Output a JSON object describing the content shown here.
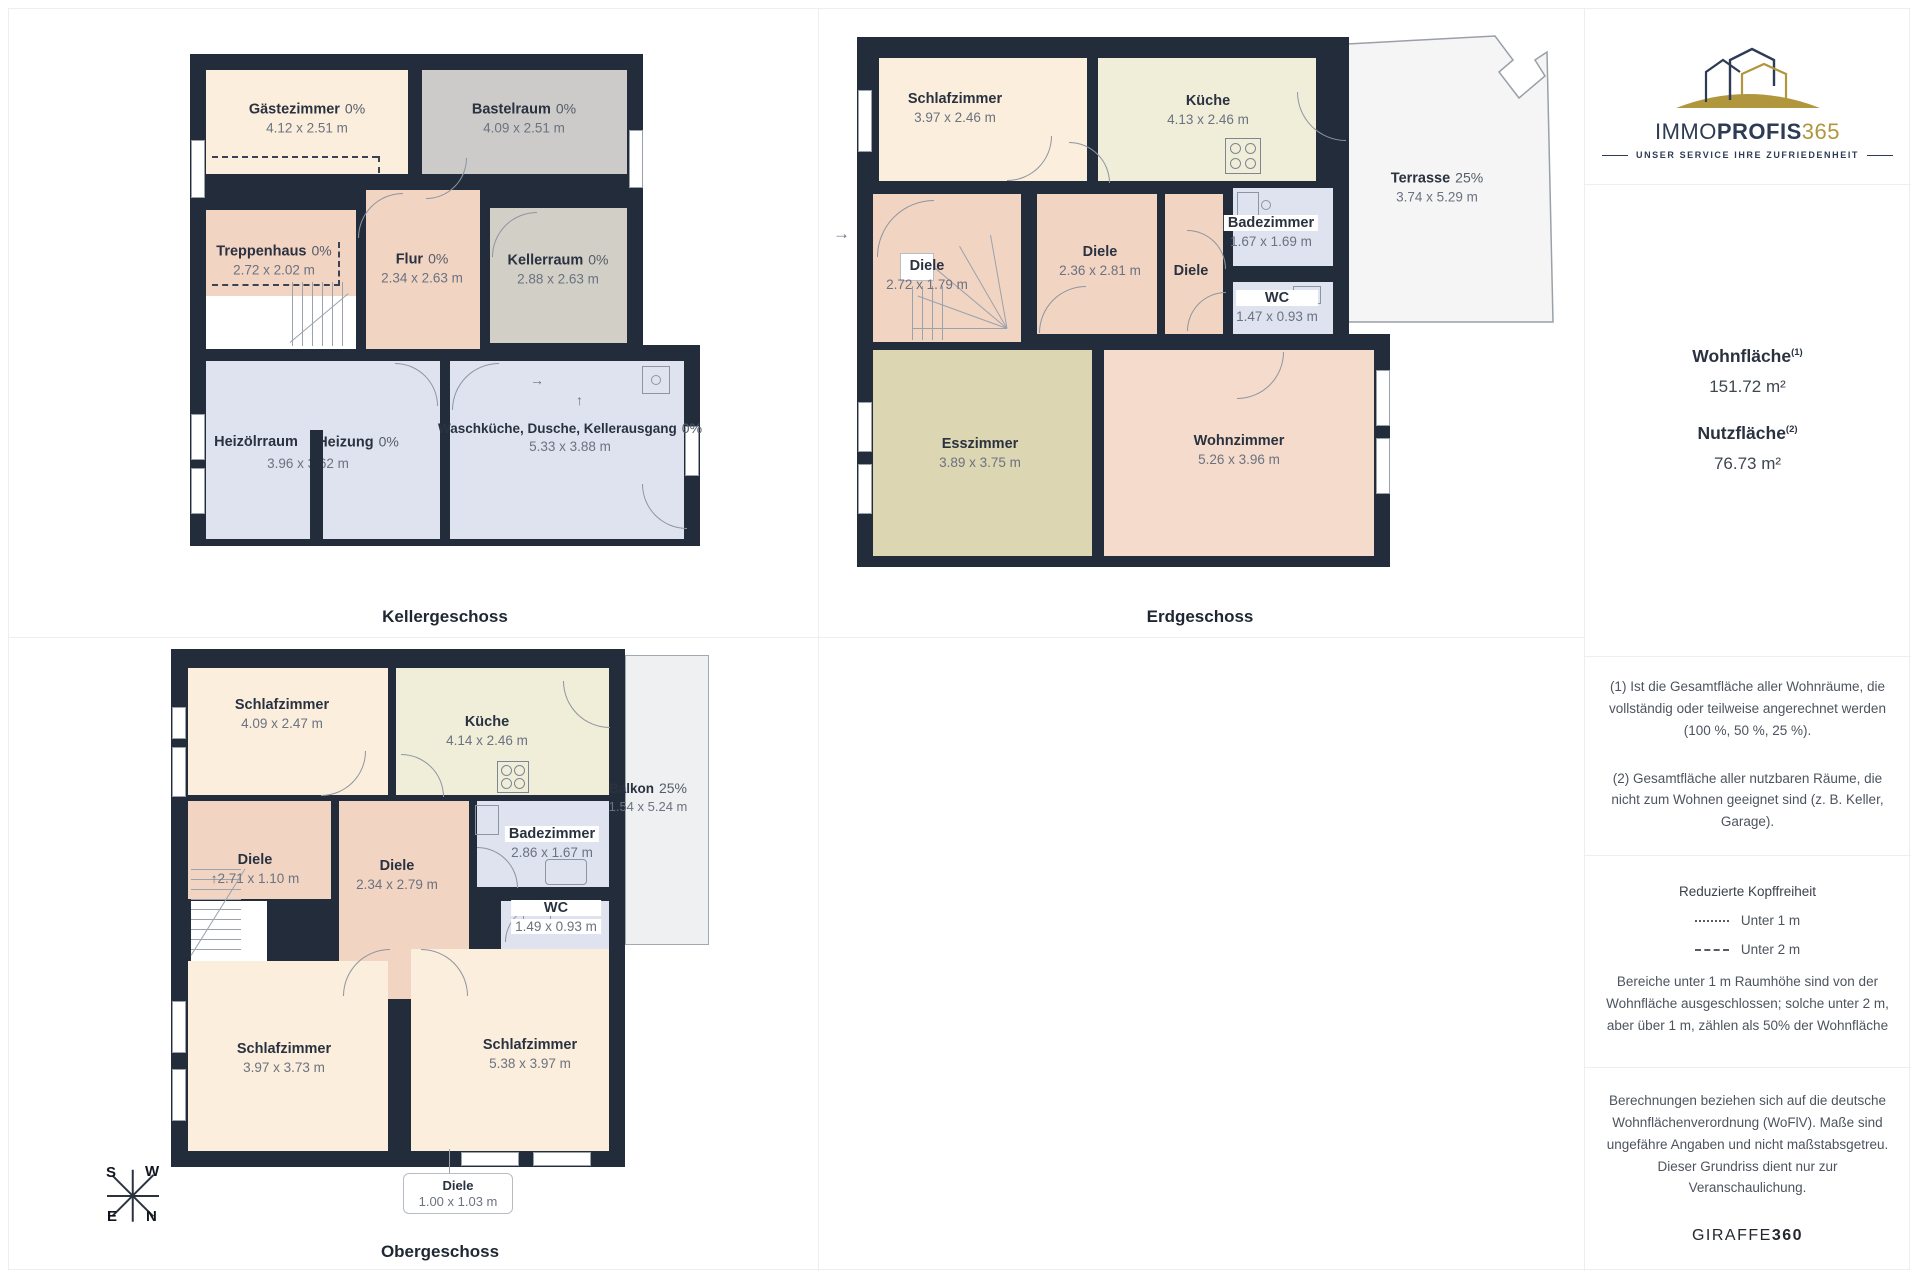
{
  "colors": {
    "wall": "#232c3a",
    "navy": "#2e3b54",
    "gold": "#b0973e",
    "salmon": "#f2d4c3",
    "cream": "#fbeedc",
    "lightblue": "#dee3ef"
  },
  "glyphs": {
    "arrow_right": "→",
    "arrow_up": "↑"
  },
  "compass": {
    "tl": "S",
    "tr": "W",
    "bl": "E",
    "br": "N"
  },
  "floors": [
    {
      "caption": "Kellergeschoss",
      "rooms": [
        {
          "name": "Gästezimmer",
          "pct": "0%",
          "dims": "4.12 x 2.51 m"
        },
        {
          "name": "Bastelraum",
          "pct": "0%",
          "dims": "4.09 x 2.51 m"
        },
        {
          "name": "Treppenhaus",
          "pct": "0%",
          "dims": "2.72 x 2.02 m"
        },
        {
          "name": "Flur",
          "pct": "0%",
          "dims": "2.34 x 2.63 m"
        },
        {
          "name": "Kellerraum",
          "pct": "0%",
          "dims": "2.88 x 2.63 m"
        },
        {
          "name": "Heizölrraum",
          "dims": "3.96 x 3.62 m"
        },
        {
          "name": "Heizung",
          "pct": "0%"
        },
        {
          "name": "Waschküche, Dusche, Kellerausgang",
          "pct": "0%",
          "dims": "5.33 x 3.88 m"
        }
      ]
    },
    {
      "caption": "Erdgeschoss",
      "rooms": [
        {
          "name": "Schlafzimmer",
          "dims": "3.97 x 2.46 m"
        },
        {
          "name": "Küche",
          "dims": "4.13 x 2.46 m"
        },
        {
          "name": "Terrasse",
          "pct": "25%",
          "dims": "3.74 x 5.29 m"
        },
        {
          "name": "Diele",
          "dims": "2.72 x 1.79 m"
        },
        {
          "name": "Diele",
          "dims": "2.36 x 2.81 m"
        },
        {
          "name": "Diele"
        },
        {
          "name": "Badezimmer",
          "dims": "1.67 x 1.69 m"
        },
        {
          "name": "WC",
          "dims": "1.47 x 0.93 m"
        },
        {
          "name": "Esszimmer",
          "dims": "3.89 x 3.75 m"
        },
        {
          "name": "Wohnzimmer",
          "dims": "5.26 x 3.96 m"
        }
      ]
    },
    {
      "caption": "Obergeschoss",
      "rooms": [
        {
          "name": "Schlafzimmer",
          "dims": "4.09 x 2.47 m"
        },
        {
          "name": "Küche",
          "dims": "4.14 x 2.46 m"
        },
        {
          "name": "Balkon",
          "pct": "25%",
          "dims": "1.54 x 5.24 m"
        },
        {
          "name": "Diele",
          "dims": "2.71 x 1.10 m"
        },
        {
          "name": "Diele",
          "dims": "2.34 x 2.79 m"
        },
        {
          "name": "Badezimmer",
          "dims": "2.86 x 1.67 m"
        },
        {
          "name": "WC",
          "dims": "1.49 x 0.93 m"
        },
        {
          "name": "Schlafzimmer",
          "dims": "3.97 x 3.73 m"
        },
        {
          "name": "Schlafzimmer",
          "dims": "5.38 x 3.97 m"
        },
        {
          "name": "Diele",
          "dims": "1.00 x 1.03 m"
        }
      ]
    }
  ],
  "sidebar": {
    "logo": {
      "immo": "IMMO",
      "profis": "PROFIS",
      "num365": "365",
      "tagline": "UNSER SERVICE IHRE ZUFRIEDENHEIT"
    },
    "areas": {
      "wohnflaeche_label": "Wohnfläche",
      "wohnflaeche_sup": "(1)",
      "wohnflaeche_value": "151.72 m²",
      "nutzflaeche_label": "Nutzfläche",
      "nutzflaeche_sup": "(2)",
      "nutzflaeche_value": "76.73 m²"
    },
    "footnotes": {
      "f1": "(1) Ist die Gesamtfläche aller Wohnräume, die vollständig oder teilweise angerechnet werden (100 %, 50 %, 25 %).",
      "f2": "(2) Gesamtfläche aller nutzbaren Räume, die nicht zum Wohnen geeignet sind (z. B. Keller, Garage)."
    },
    "headroom": {
      "title": "Reduzierte Kopffreiheit",
      "legend_under1": "Unter 1 m",
      "legend_under2": "Unter 2 m",
      "body": "Bereiche unter 1 m Raumhöhe sind von der Wohnfläche ausgeschlossen; solche unter 2 m, aber über 1 m, zählen als 50% der Wohnfläche"
    },
    "disclaimer": {
      "body": "Berechnungen beziehen sich auf die deutsche Wohnflächenverordnung (WoFlV). Maße sind ungefähre Angaben und nicht maßstabsgetreu. Dieser Grundriss dient nur zur Veranschaulichung.",
      "giraffe": "GIRAFFE",
      "giraffe360": "360"
    }
  }
}
